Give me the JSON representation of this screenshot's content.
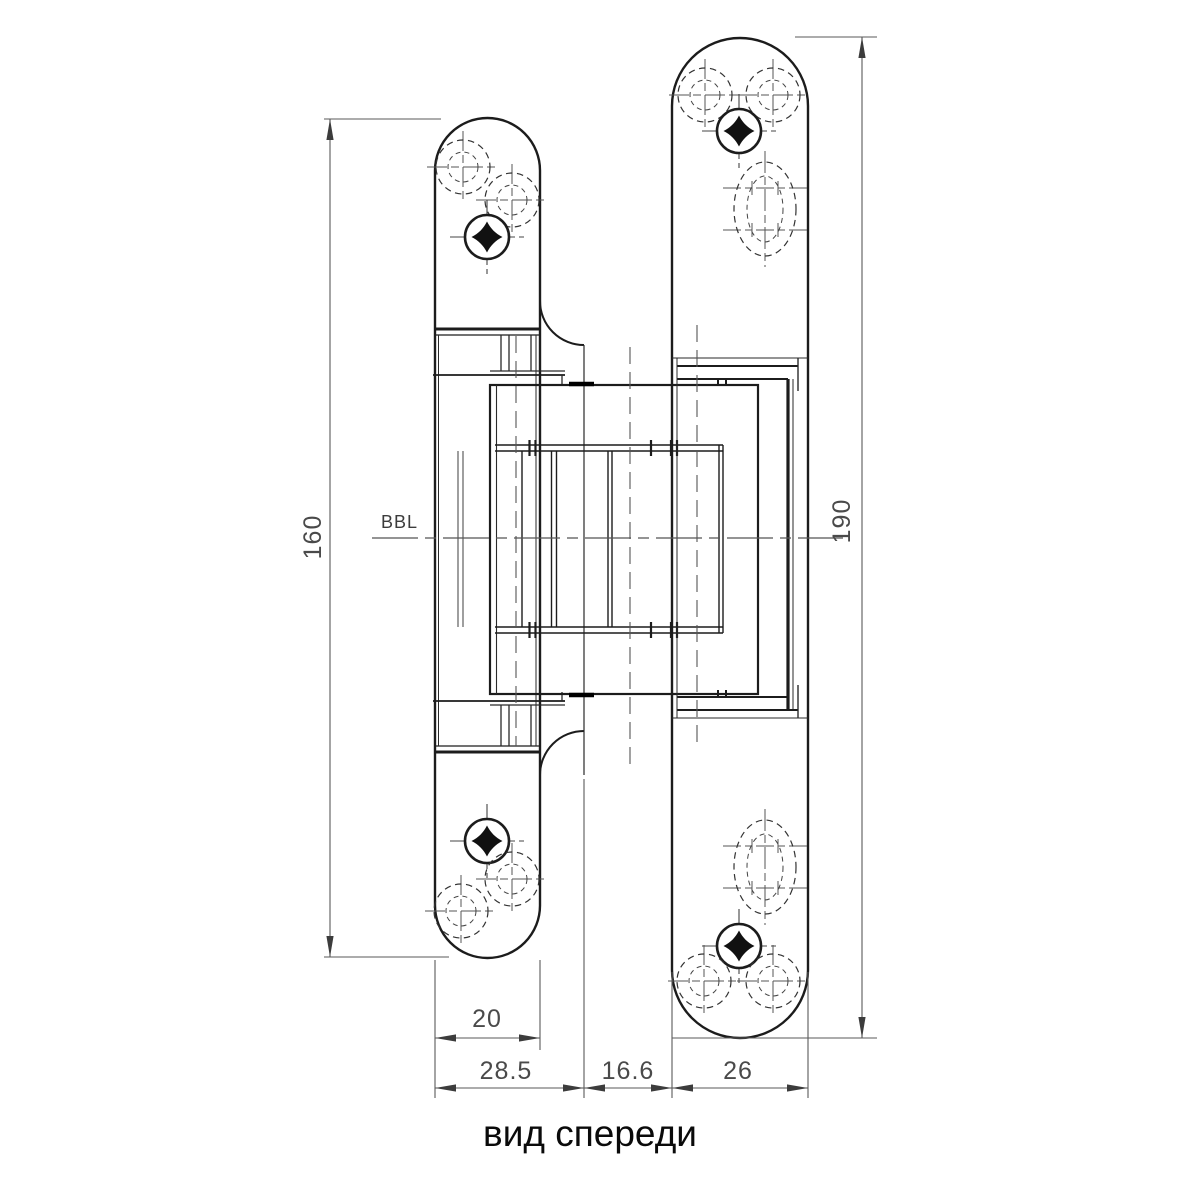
{
  "drawing": {
    "caption": "вид спереди",
    "reference_line_label": "BBL",
    "dimensions": {
      "left_plate_height": "160",
      "right_plate_height": "190",
      "left_plate_width": "20",
      "left_total_width": "28.5",
      "middle_gap": "16.6",
      "right_plate_width": "26"
    }
  }
}
